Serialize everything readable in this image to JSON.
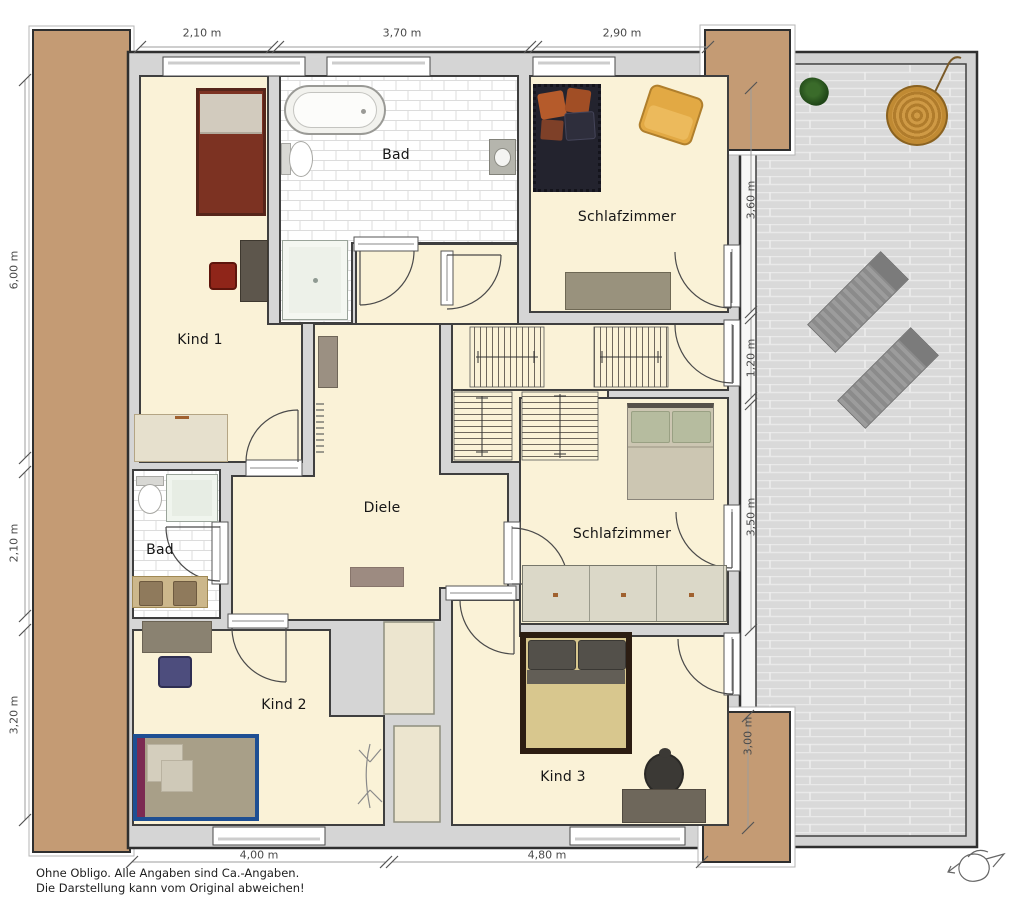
{
  "plan": {
    "room_labels": {
      "kind1": "Kind 1",
      "bad_top": "Bad",
      "schlafzimmer_top": "Schlafzimmer",
      "diele": "Diele",
      "bad_small": "Bad",
      "kind2": "Kind 2",
      "schlafzimmer_bottom": "Schlafzimmer",
      "kind3": "Kind 3"
    },
    "dimensions": {
      "top": [
        "2,10 m",
        "3,70 m",
        "2,90 m"
      ],
      "left": [
        "6,00 m",
        "2,10 m",
        "3,20 m"
      ],
      "right": [
        "3,60 m",
        "1,20 m",
        "3,50 m",
        "3,00 m"
      ],
      "bottom": [
        "4,00 m",
        "4,80 m"
      ]
    },
    "disclaimer_line1": "Ohne Obligo. Alle Angaben sind Ca.-Angaben.",
    "disclaimer_line2": "Die Darstellung kann vom Original abweichen!",
    "icons": {
      "compass": "compass-north"
    },
    "colors": {
      "room_floor": "#faf2d7",
      "wall": "#d5d5d5",
      "wall_line": "#2f2f2f",
      "balcony": "#c49b74",
      "deck": "#d9d9d9",
      "dim_text": "#4a4a4a",
      "label_text": "#161616"
    }
  }
}
